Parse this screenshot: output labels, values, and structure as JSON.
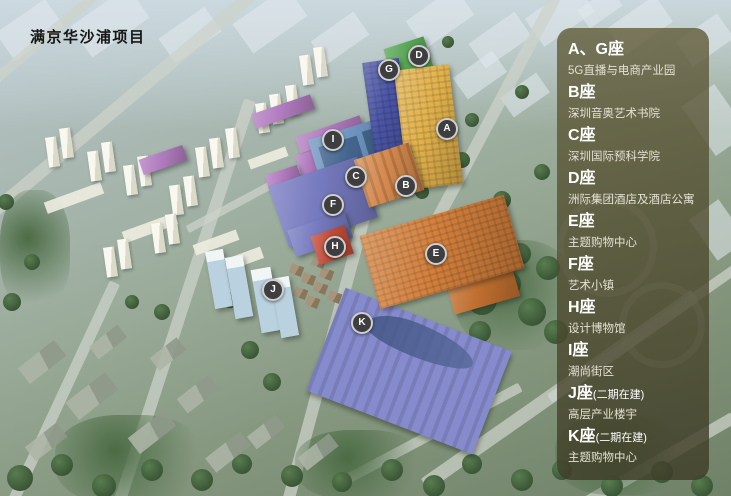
{
  "title": "满京华沙浦项目",
  "legend": {
    "items": [
      {
        "label": "A、G座",
        "suffix": "",
        "desc": "5G直播与电商产业园"
      },
      {
        "label": "B座",
        "suffix": "",
        "desc": "深圳音奥艺术书院"
      },
      {
        "label": "C座",
        "suffix": "",
        "desc": "深圳国际预科学院"
      },
      {
        "label": "D座",
        "suffix": "",
        "desc": "洲际集团酒店及酒店公寓"
      },
      {
        "label": "E座",
        "suffix": "",
        "desc": "主题购物中心"
      },
      {
        "label": "F座",
        "suffix": "",
        "desc": "艺术小镇"
      },
      {
        "label": "H座",
        "suffix": "",
        "desc": "设计博物馆"
      },
      {
        "label": "I座",
        "suffix": "",
        "desc": "潮尚街区"
      },
      {
        "label": "J座",
        "suffix": "(二期在建)",
        "desc": "高层产业楼宇"
      },
      {
        "label": "K座",
        "suffix": "(二期在建)",
        "desc": "主题购物中心"
      }
    ]
  },
  "markers": [
    {
      "letter": "G",
      "x": 387,
      "y": 68
    },
    {
      "letter": "D",
      "x": 417,
      "y": 54
    },
    {
      "letter": "A",
      "x": 445,
      "y": 127
    },
    {
      "letter": "I",
      "x": 331,
      "y": 138
    },
    {
      "letter": "C",
      "x": 354,
      "y": 175
    },
    {
      "letter": "B",
      "x": 404,
      "y": 184
    },
    {
      "letter": "F",
      "x": 331,
      "y": 203
    },
    {
      "letter": "H",
      "x": 333,
      "y": 245
    },
    {
      "letter": "E",
      "x": 434,
      "y": 252
    },
    {
      "letter": "J",
      "x": 271,
      "y": 288
    },
    {
      "letter": "K",
      "x": 360,
      "y": 321
    }
  ],
  "colors": {
    "A": "#e2b24c",
    "G": "#4b55a6",
    "D": "#58a556",
    "D_side": "#4e9a50",
    "B": "#d5894e",
    "C": "#6e94bf",
    "I": "#b27cc0",
    "F": "#767abf",
    "H": "#c14b38",
    "E": "#d3803c",
    "E_side": "#c06f2f",
    "J": "#bdd4e2",
    "K": "#868bcd",
    "marker_bg": "#3e3e40",
    "marker_ring": "#cfcfcf",
    "marker_text": "#ffffff",
    "title_color": "#161616",
    "panel_bg": "#4c4830"
  }
}
